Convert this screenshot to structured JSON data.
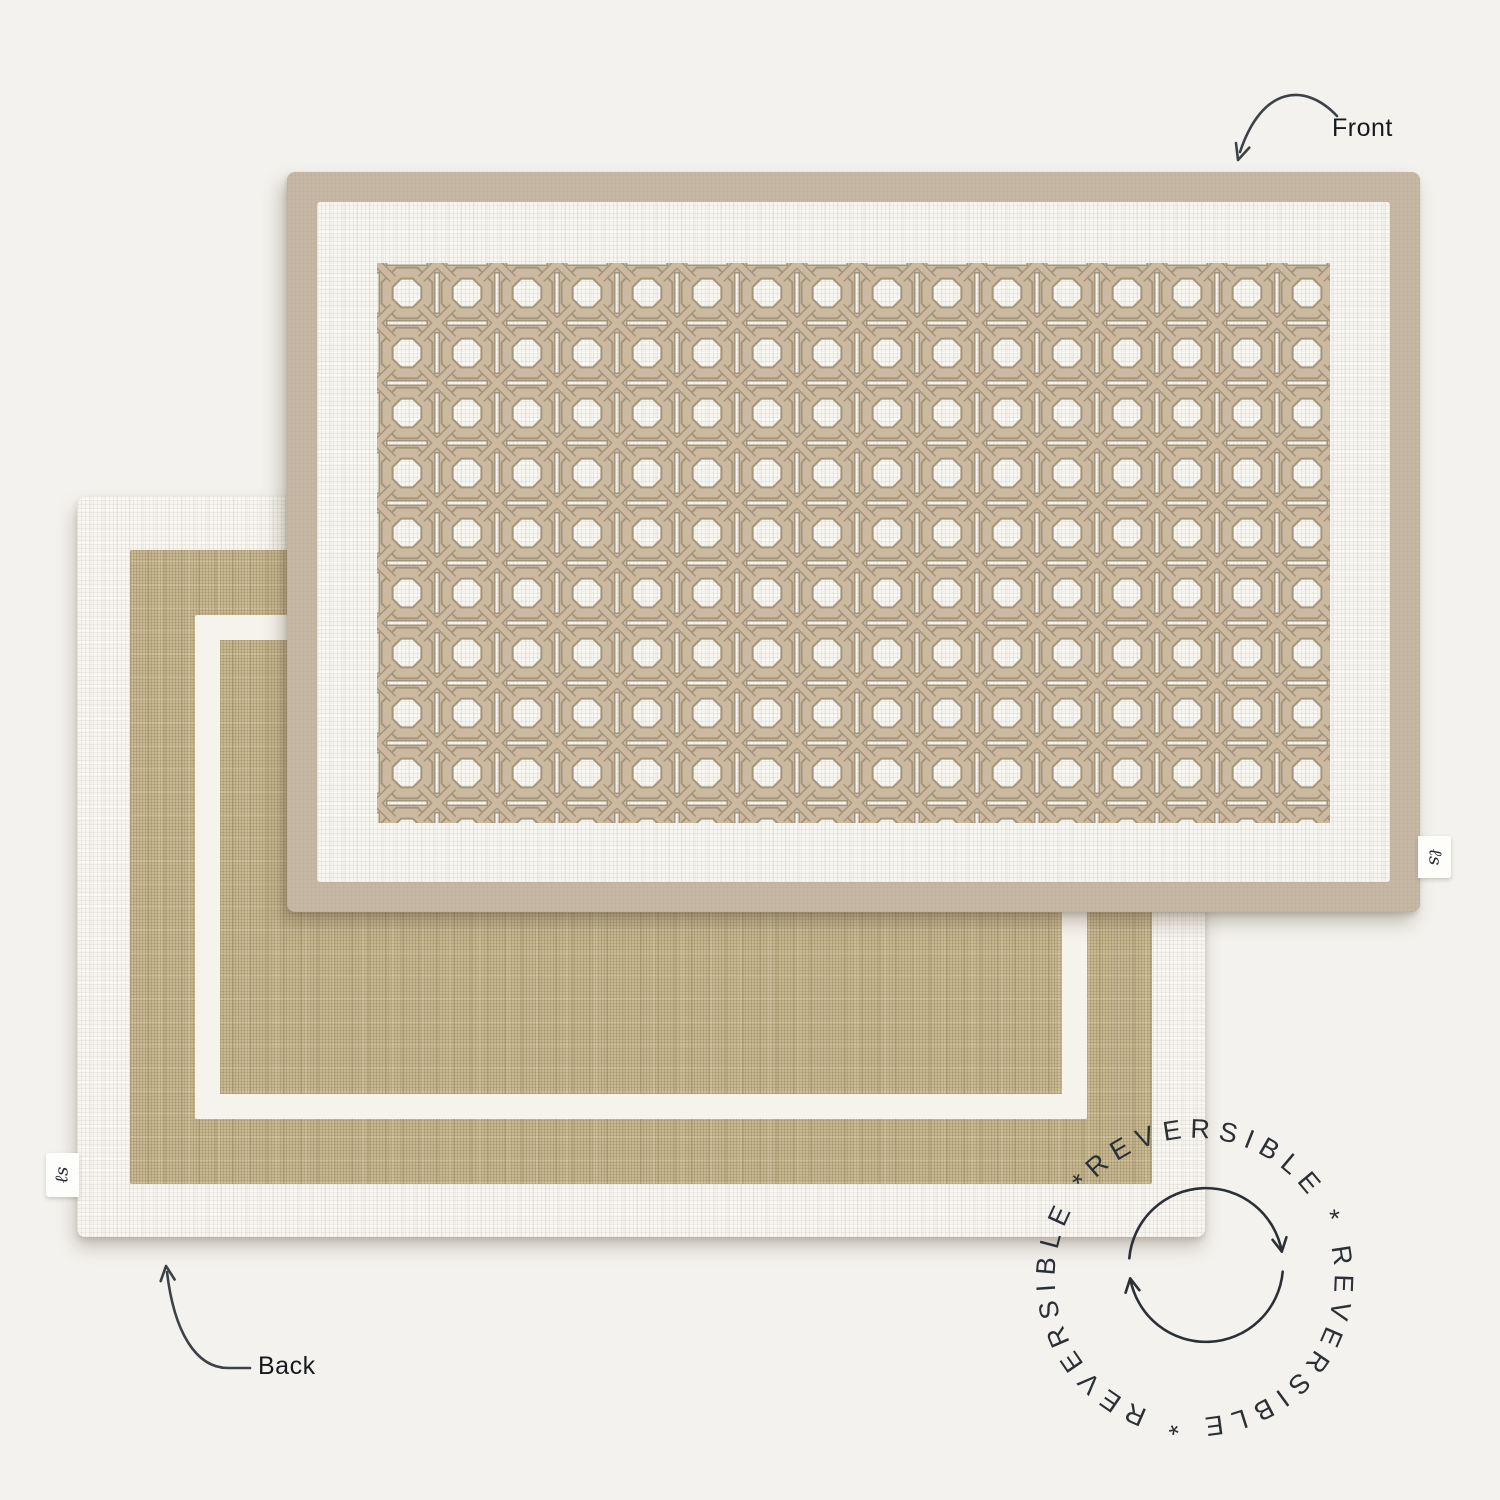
{
  "scene": {
    "background_color": "#f4f2ee"
  },
  "annotations": {
    "front_label": "Front",
    "back_label": "Back",
    "arrow_color": "#3d4249",
    "badge_text": "REVERSIBLE * REVERSIBLE * REVERSIBLE * ",
    "badge_color": "#2b3036"
  },
  "front_mat": {
    "description": "placemat front side with cane weave pattern",
    "border_color": "#c7b8a5",
    "base_color": "#f7f5ef",
    "cane_color": "#cbbaa0",
    "cane_outline_color": "#a3947b",
    "tag_monogram": "ℓs"
  },
  "back_mat": {
    "description": "placemat back side in plain linen",
    "border_color": "#f9f7f2",
    "field_color": "#c6b791",
    "outline_color": "#f6f3ec",
    "tag_monogram": "ℓs"
  }
}
